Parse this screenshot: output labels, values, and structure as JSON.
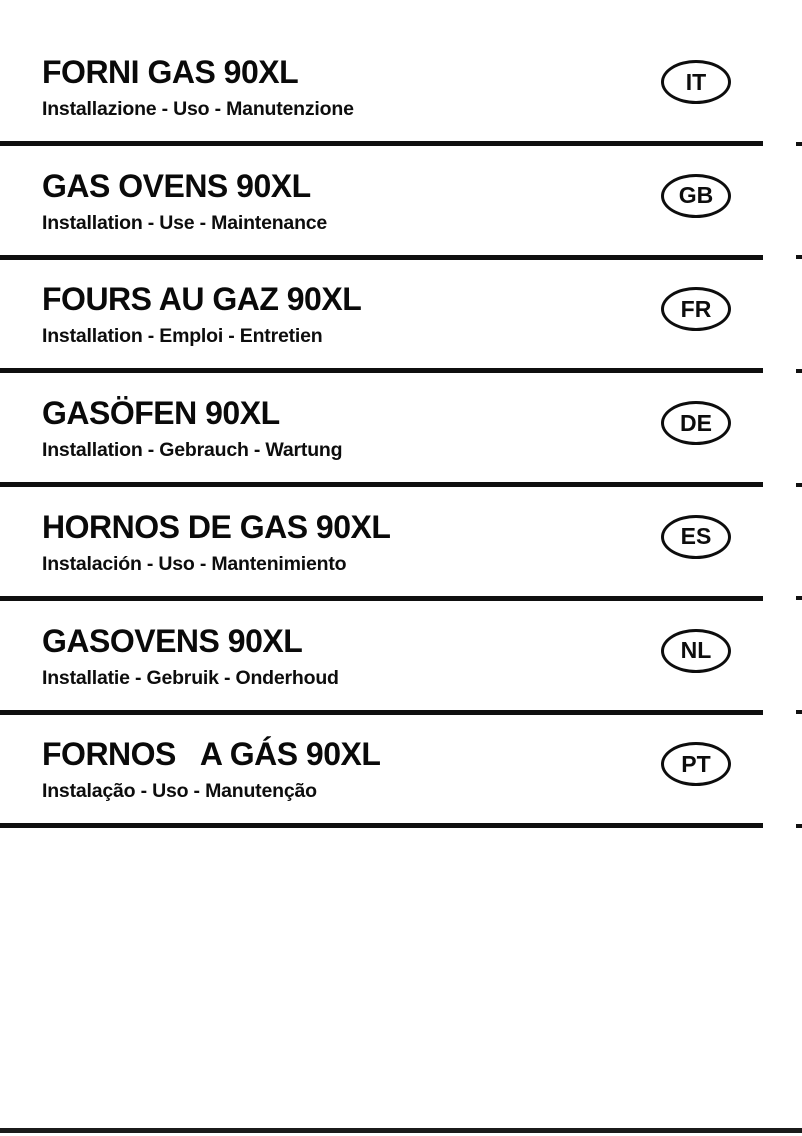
{
  "page": {
    "type": "manual-cover",
    "background_color": "#ffffff",
    "text_color": "#0a0a0a",
    "rule_color": "#0f0f0f",
    "bottom_rule_color": "#1b1b1b"
  },
  "sections": [
    {
      "code": "IT",
      "title": "FORNI GAS 90XL",
      "subtitle": "Installazione - Uso - Manutenzione"
    },
    {
      "code": "GB",
      "title": "GAS OVENS 90XL",
      "subtitle": "Installation - Use - Maintenance"
    },
    {
      "code": "FR",
      "title": "FOURS AU GAZ 90XL",
      "subtitle": "Installation - Emploi - Entretien"
    },
    {
      "code": "DE",
      "title": "GASÖFEN 90XL",
      "subtitle": "Installation - Gebrauch - Wartung"
    },
    {
      "code": "ES",
      "title": "HORNOS DE GAS 90XL",
      "subtitle": "Instalación - Uso - Mantenimiento"
    },
    {
      "code": "NL",
      "title": "GASOVENS 90XL",
      "subtitle": "Installatie - Gebruik - Onderhoud"
    },
    {
      "code": "PT",
      "title": "FORNOS   A GÁS 90XL",
      "subtitle": "Instalação - Uso - Manutenção"
    }
  ]
}
